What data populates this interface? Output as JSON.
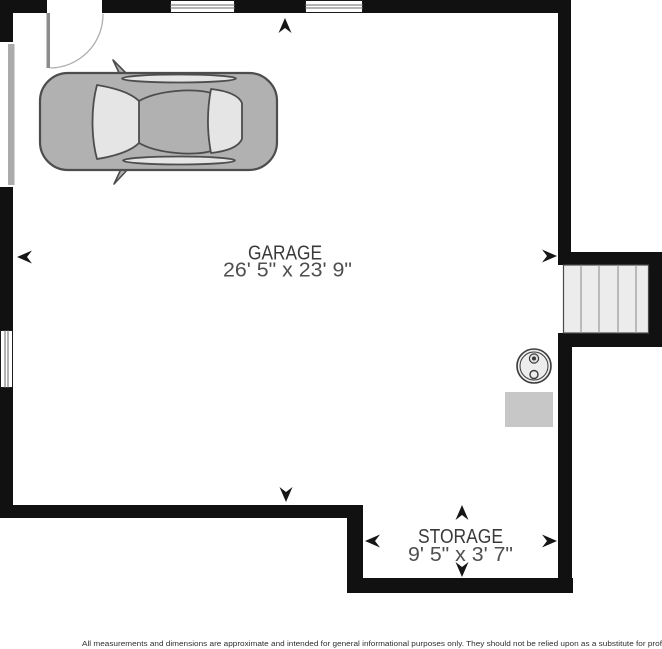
{
  "floorplan": {
    "rooms": [
      {
        "name": "GARAGE",
        "dimensions": "26' 5\" x 23' 9\""
      },
      {
        "name": "STORAGE",
        "dimensions": "9' 5\" x 3' 7\""
      }
    ],
    "disclaimer": "All measurements and dimensions are approximate and intended for general informational purposes only. They should not be relied upon as a substitute for prof",
    "symbols": [
      "car-top-view",
      "staircase",
      "water-heater",
      "utility-pad",
      "door-swing",
      "garage-door",
      "window",
      "dimension-arrows"
    ],
    "colors": {
      "wall": "#111111",
      "arrow": "#161616",
      "car_body": "#b1b1b1",
      "car_glass": "#e5e5e5",
      "stair_fill": "#ececec",
      "fixture_gray": "#c7c7c7",
      "door_gray": "#ababab",
      "label_dark": "#3a3a3a",
      "label_gray": "#4f4f4f",
      "disclaimer_text": "#2e2e2e"
    }
  }
}
